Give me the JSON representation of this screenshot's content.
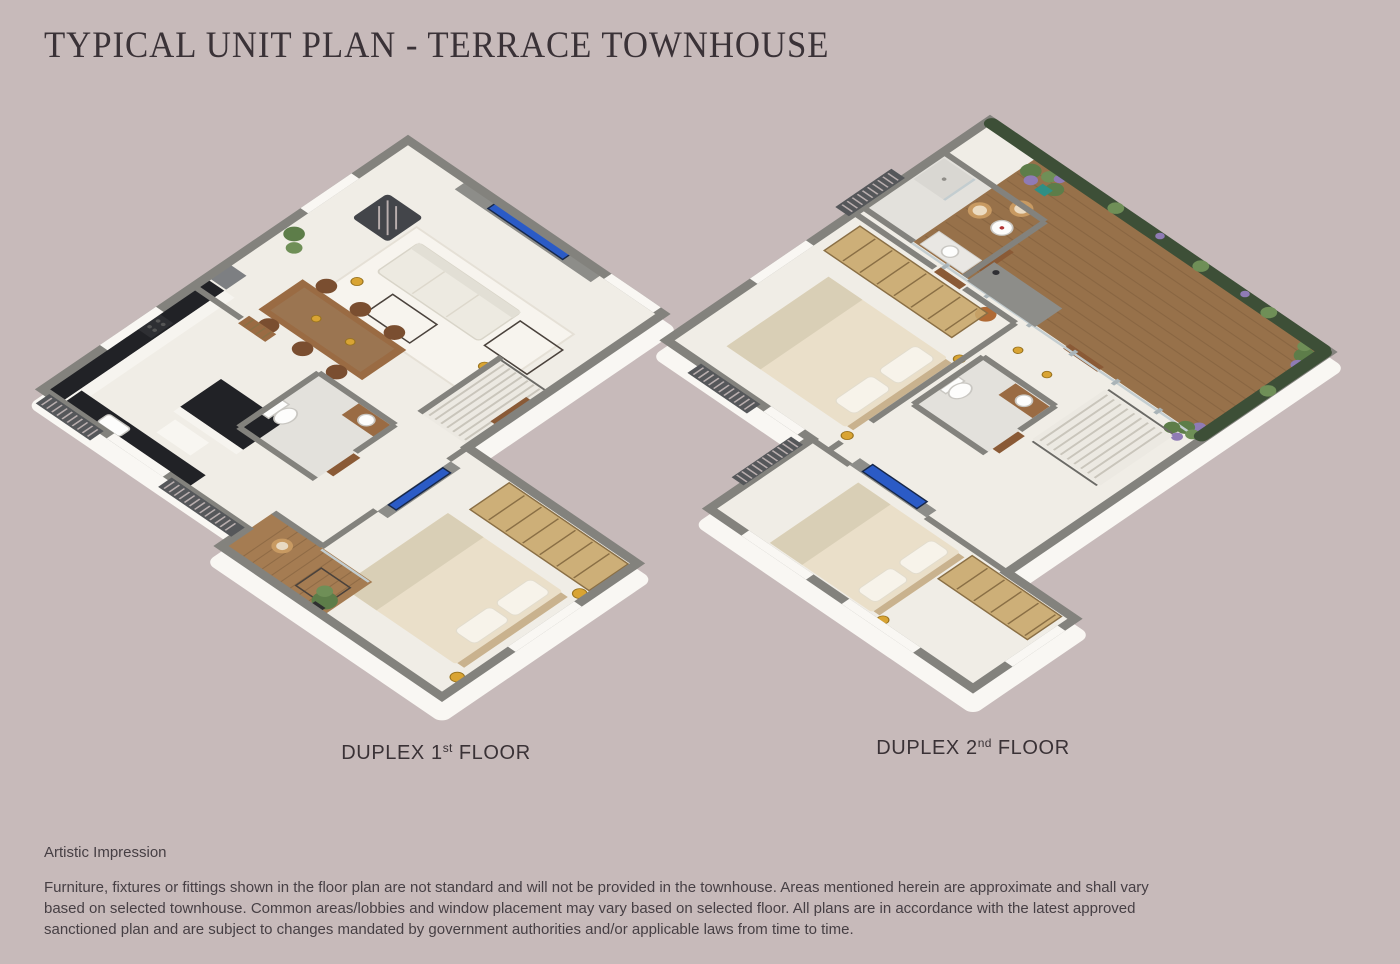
{
  "page": {
    "title": "TYPICAL UNIT PLAN - TERRACE TOWNHOUSE",
    "background": "#c7baba"
  },
  "floorplans": [
    {
      "name": "duplex-1st-floor",
      "label_prefix": "DUPLEX 1",
      "ordinal_suffix": "st",
      "label_rest": " FLOOR"
    },
    {
      "name": "duplex-2nd-floor",
      "label_prefix": "DUPLEX 2",
      "ordinal_suffix": "nd",
      "label_rest": " FLOOR"
    }
  ],
  "footnotes": {
    "artistic_impression": "Artistic Impression",
    "disclaimer": "Furniture, fixtures or fittings shown in the floor plan are not standard and will not be provided in the townhouse. Areas mentioned herein are approximate and shall vary\nbased on selected townhouse. Common areas/lobbies and window placement may vary based on selected floor. All plans are in accordance with the latest approved\nsanctioned plan and are subject to changes mandated by government authorities and/or applicable laws from time to time."
  },
  "colors": {
    "background": "#c7baba",
    "title_text": "#3a3237",
    "label_text": "#3a3236",
    "body_text": "#463f44",
    "wall_gray": "#83827d",
    "floor_cream": "#f0ede6",
    "slab_white": "#f9f7f3",
    "wood_deck": "#97714a",
    "balcony_wood": "#a57c52",
    "hedge_green": "#3d4f37",
    "plant_green": "#5d7d49",
    "accent_purple": "#8f7bb5",
    "wardrobe_gold": "#c9a76c",
    "tv_blue": "#2b5bc6",
    "counter_black": "#212226",
    "bed_cream": "#eadfc9",
    "lamp_gold": "#d9a433",
    "louver_gray": "#55575a"
  }
}
